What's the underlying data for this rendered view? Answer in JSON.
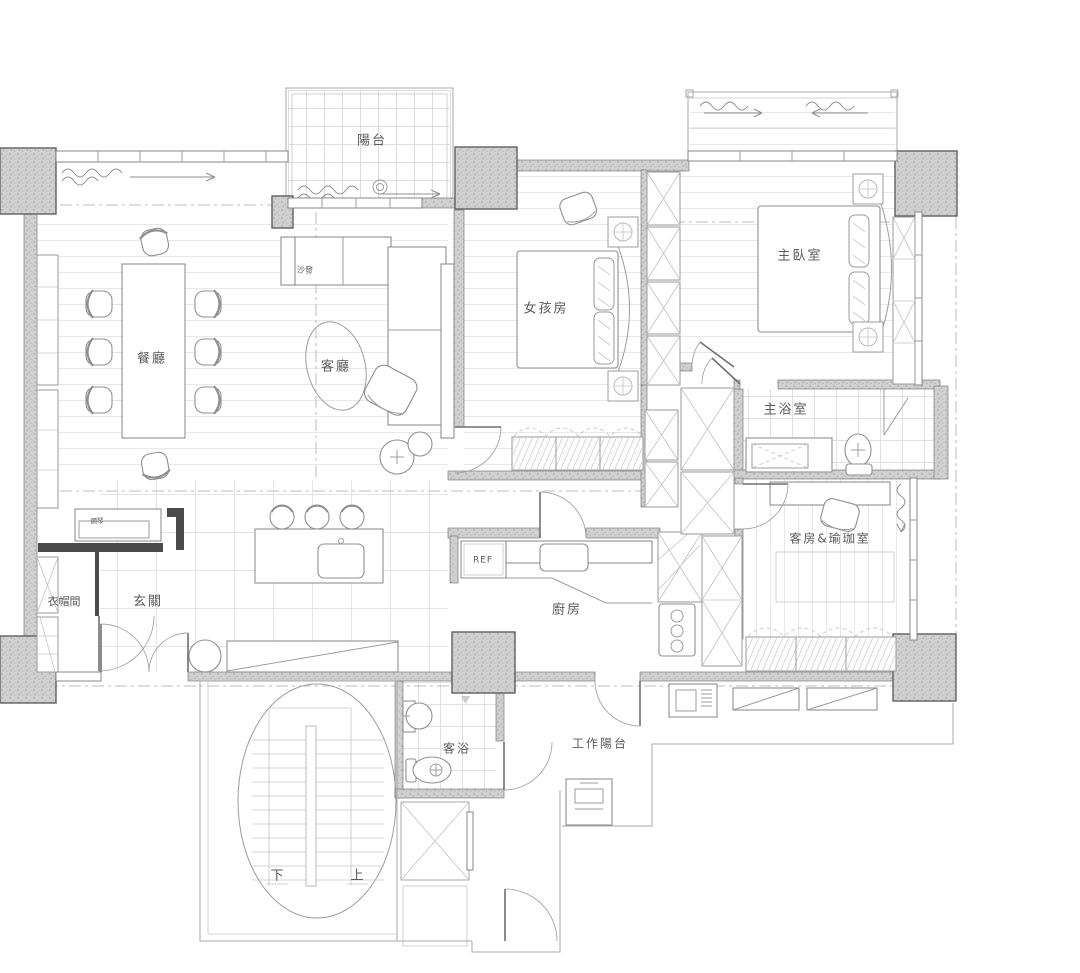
{
  "document": {
    "type": "residential-floor-plan",
    "language": "zh-TW"
  },
  "colors": {
    "wall_fill": "#cfcfcf",
    "line": "#8f8f8f",
    "text": "#5a5a5a",
    "dark_accent": "#4a4a4a",
    "background": "#ffffff"
  },
  "rooms": [
    {
      "id": "balcony",
      "label": "陽台"
    },
    {
      "id": "dining-room",
      "label": "餐廳"
    },
    {
      "id": "living-room",
      "label": "客廳"
    },
    {
      "id": "girls-room",
      "label": "女孩房"
    },
    {
      "id": "master-bedroom",
      "label": "主臥室"
    },
    {
      "id": "master-bath",
      "label": "主浴室"
    },
    {
      "id": "guest-yoga-room",
      "label": "客房&瑜珈室"
    },
    {
      "id": "cloakroom",
      "label": "衣帽間"
    },
    {
      "id": "foyer",
      "label": "玄關"
    },
    {
      "id": "kitchen",
      "label": "廚房"
    },
    {
      "id": "guest-bath",
      "label": "客浴"
    },
    {
      "id": "work-balcony",
      "label": "工作陽台"
    }
  ],
  "annotations": {
    "sofa": "沙發",
    "piano": "鋼琴",
    "fridge": "REF",
    "stair_down": "下",
    "stair_up": "上"
  }
}
